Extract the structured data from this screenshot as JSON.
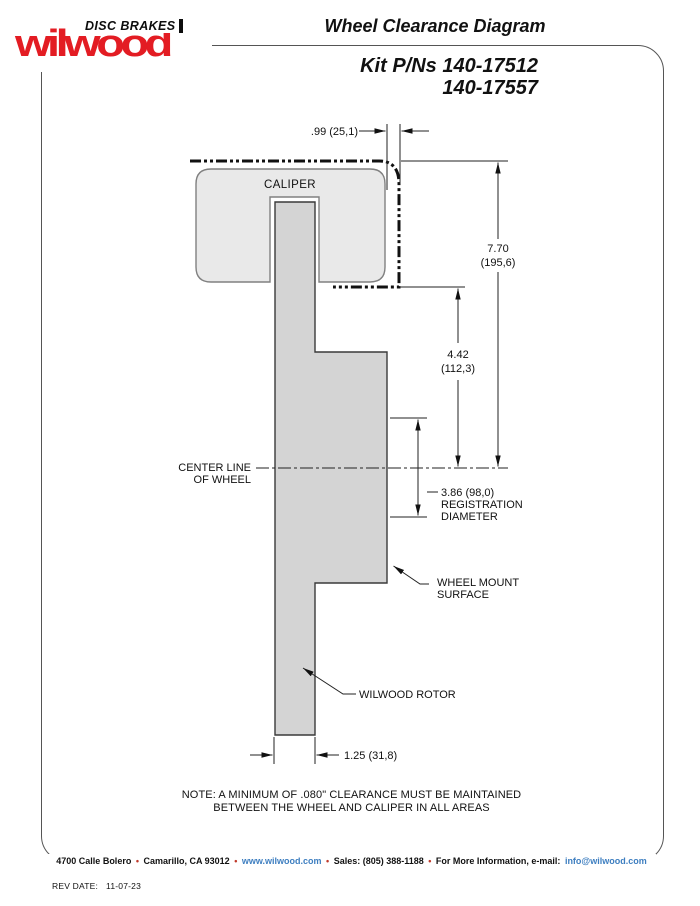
{
  "header": {
    "logo_brand": "wilwood",
    "logo_tagline": "DISC BRAKES",
    "title": "Wheel Clearance Diagram",
    "kit_line1": "Kit P/Ns 140-17512",
    "kit_line2": "140-17557"
  },
  "diagram": {
    "caliper_label": "CALIPER",
    "dim_clearance": ".99 (25,1)",
    "dim_height_val": "7.70",
    "dim_height_mm": "(195,6)",
    "dim_mid_val": "4.42",
    "dim_mid_mm": "(112,3)",
    "centerline_line1": "CENTER LINE",
    "centerline_line2": "OF WHEEL",
    "dim_reg_val": "3.86 (98,0)",
    "dim_reg_line2": "REGISTRATION",
    "dim_reg_line3": "DIAMETER",
    "wheel_mount_line1": "WHEEL MOUNT",
    "wheel_mount_line2": "SURFACE",
    "rotor_label": "WILWOOD ROTOR",
    "dim_width": "1.25 (31,8)"
  },
  "note": {
    "line1": "NOTE: A MINIMUM OF .080\" CLEARANCE MUST BE MAINTAINED",
    "line2": "BETWEEN THE WHEEL AND CALIPER IN ALL AREAS"
  },
  "footer": {
    "address": "4700 Calle Bolero",
    "bullet": "•",
    "city": "Camarillo, CA 93012",
    "url": "www.wilwood.com",
    "sales": "Sales: (805) 388-1188",
    "info": "For More Information, e-mail:",
    "email": "info@wilwood.com",
    "rev_label": "REV DATE:",
    "rev_date": "11-07-23"
  },
  "colors": {
    "brand_red": "#e31c23",
    "link_blue": "#3d7ec0",
    "bullet_red": "#c03a2b",
    "caliper_fill": "#e9e9e9",
    "rotor_fill": "#d4d4d4",
    "frame_gray": "#555555"
  }
}
